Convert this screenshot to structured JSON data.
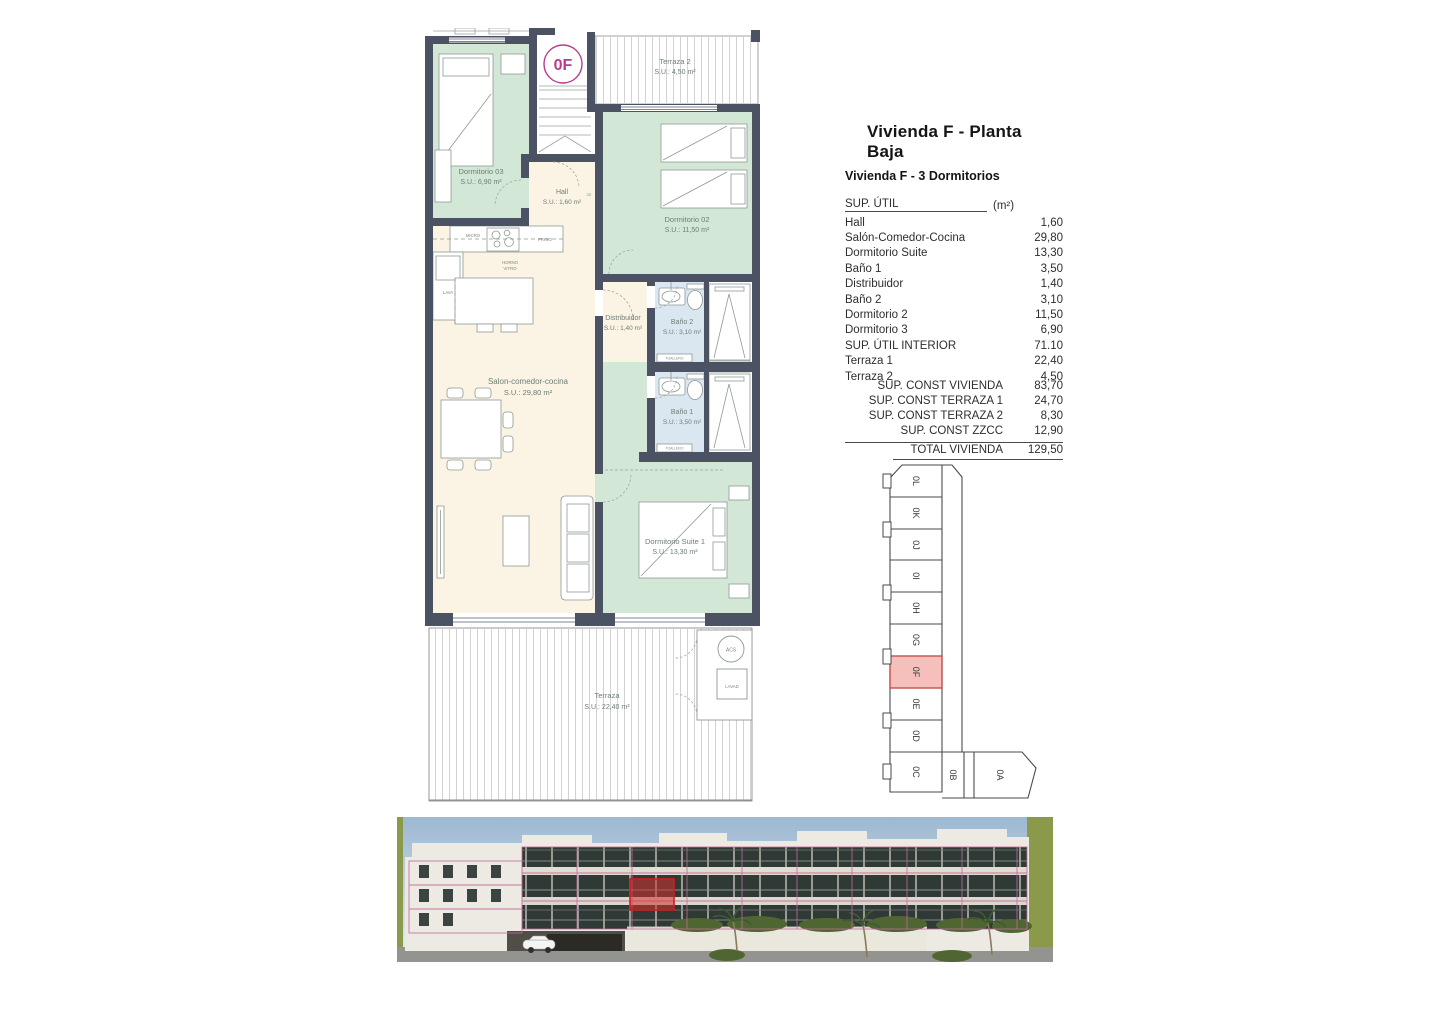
{
  "title": "Vivienda F - Planta Baja",
  "subtitle": "Vivienda F - 3 Dormitorios",
  "area_table": {
    "header": {
      "label": "SUP. ÚTIL",
      "unit": "(m²)"
    },
    "rows": [
      {
        "label": "Hall",
        "value": "1,60"
      },
      {
        "label": "Salón-Comedor-Cocina",
        "value": "29,80"
      },
      {
        "label": "Dormitorio Suite",
        "value": "13,30"
      },
      {
        "label": "Baño 1",
        "value": "3,50"
      },
      {
        "label": "Distribuidor",
        "value": "1,40"
      },
      {
        "label": "Baño 2",
        "value": "3,10"
      },
      {
        "label": "Dormitorio 2",
        "value": "11,50"
      },
      {
        "label": "Dormitorio 3",
        "value": "6,90"
      },
      {
        "label": "SUP. ÚTIL INTERIOR",
        "value": "71.10"
      },
      {
        "label": "Terraza 1",
        "value": "22,40"
      },
      {
        "label": "Terraza 2",
        "value": "4,50"
      }
    ]
  },
  "summary_table": {
    "rows": [
      {
        "label": "SUP. CONST VIVIENDA",
        "value": "83,70"
      },
      {
        "label": "SUP. CONST TERRAZA 1",
        "value": "24,70"
      },
      {
        "label": "SUP. CONST TERRAZA 2",
        "value": "8,30"
      },
      {
        "label": "SUP. CONST ZZCC",
        "value": "12,90"
      }
    ],
    "total": {
      "label": "TOTAL VIVIENDA",
      "value": "129,50"
    }
  },
  "floor_plan": {
    "unit_badge": "0F",
    "rooms": {
      "dormitorio03": {
        "name": "Dormitorio 03",
        "area": "S.U.: 6,90 m²"
      },
      "hall": {
        "name": "Hall",
        "area": "S.U.: 1,60 m²"
      },
      "terraza2": {
        "name": "Terraza 2",
        "area": "S.U.: 4,50 m²"
      },
      "dormitorio02": {
        "name": "Dormitorio 02",
        "area": "S.U.: 11,50 m²"
      },
      "distribuidor": {
        "name": "Distribuidor",
        "area": "S.U.: 1,40 m²"
      },
      "bano2": {
        "name": "Baño 2",
        "area": "S.U.: 3,10 m²"
      },
      "bano1": {
        "name": "Baño 1",
        "area": "S.U.: 3,50 m²"
      },
      "salon": {
        "name": "Salon-comedor-cocina",
        "area": "S.U.: 29,80 m²"
      },
      "suite": {
        "name": "Dormitorio Suite 1",
        "area": "S.U.: 13,30 m²"
      },
      "terraza1": {
        "name": "Terraza",
        "area": "S.U.: 22,40 m²"
      }
    },
    "fixtures": {
      "micro": "MICRO",
      "frigo": "FRIGO",
      "horno_line1": "HORNO",
      "horno_line2": "VITRO",
      "lava": "LAVA",
      "toallero": "TOALLERO",
      "acs": "ACS",
      "lavad": "LAVAD",
      "ce": "CE"
    }
  },
  "key_plan": {
    "units": [
      "0L",
      "0K",
      "0J",
      "0I",
      "0H",
      "0G",
      "0F",
      "0E",
      "0D",
      "0C",
      "0B",
      "0A"
    ],
    "highlighted_unit": "0F"
  },
  "colors": {
    "wall": "#4a5263",
    "bedroom_fill": "#d3e7d7",
    "living_fill": "#fbf4e4",
    "bath_fill": "#dbe7f0",
    "accent_magenta": "#b93c8a",
    "keyplan_highlight": "#f5bfbc",
    "keyplan_highlight_border": "#c0453e",
    "render_outline_pink": "#c7679b",
    "render_highlight_red": "#d32f2f"
  }
}
